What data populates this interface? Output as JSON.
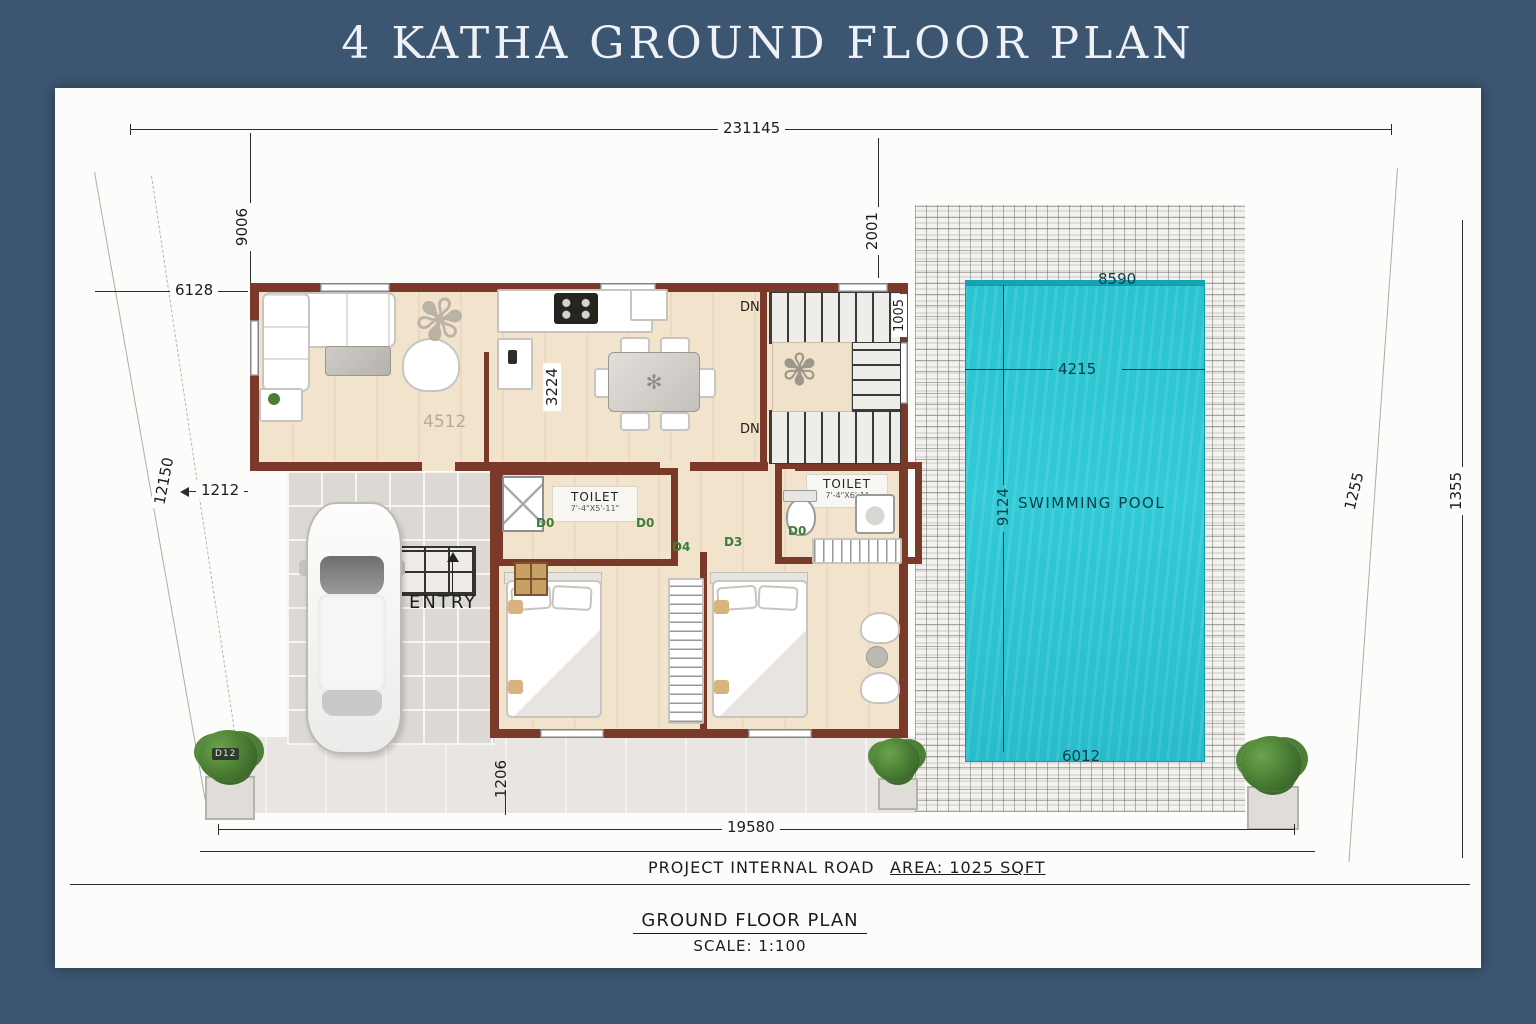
{
  "title": "4 KATHA GROUND FLOOR PLAN",
  "colors": {
    "frame": "#3c5570",
    "wall": "#7b3929",
    "pool_water": "#2ac3d1",
    "floor": "#f2e3cc",
    "pool_text": "#0d3c48",
    "door_tag_green": "#3e7c39"
  },
  "dims": {
    "top_width": "231145",
    "left_upper_v": "9006",
    "left_upper_h": "6128",
    "plot_left": "12150",
    "garage_offset": "1212",
    "deck_top": "2001",
    "pool_top": "8590",
    "stairs_side": "1005",
    "living": "4512",
    "living_v": "3224",
    "pool_w": "4215",
    "pool_h": "9124",
    "pool_bottom": "6012",
    "bed_offset": "1206",
    "bottom_width": "19580",
    "plot_right": "1255",
    "right_height": "1355"
  },
  "labels": {
    "entry": "ENTRY",
    "pool": "SWIMMING POOL",
    "toilet_1": "TOILET",
    "toilet_1_size": "7'-4\"X5'-11\"",
    "toilet_2": "TOILET",
    "toilet_2_size": "7'-4\"X6'-1\"",
    "dn": "DN",
    "road": "PROJECT INTERNAL ROAD",
    "area": "AREA: 1025 SQFT",
    "plan_name": "GROUND FLOOR PLAN",
    "scale": "SCALE: 1:100",
    "plant_tag": "D12",
    "door_tags": [
      "D0",
      "D0",
      "D0",
      "D4",
      "D3"
    ]
  }
}
